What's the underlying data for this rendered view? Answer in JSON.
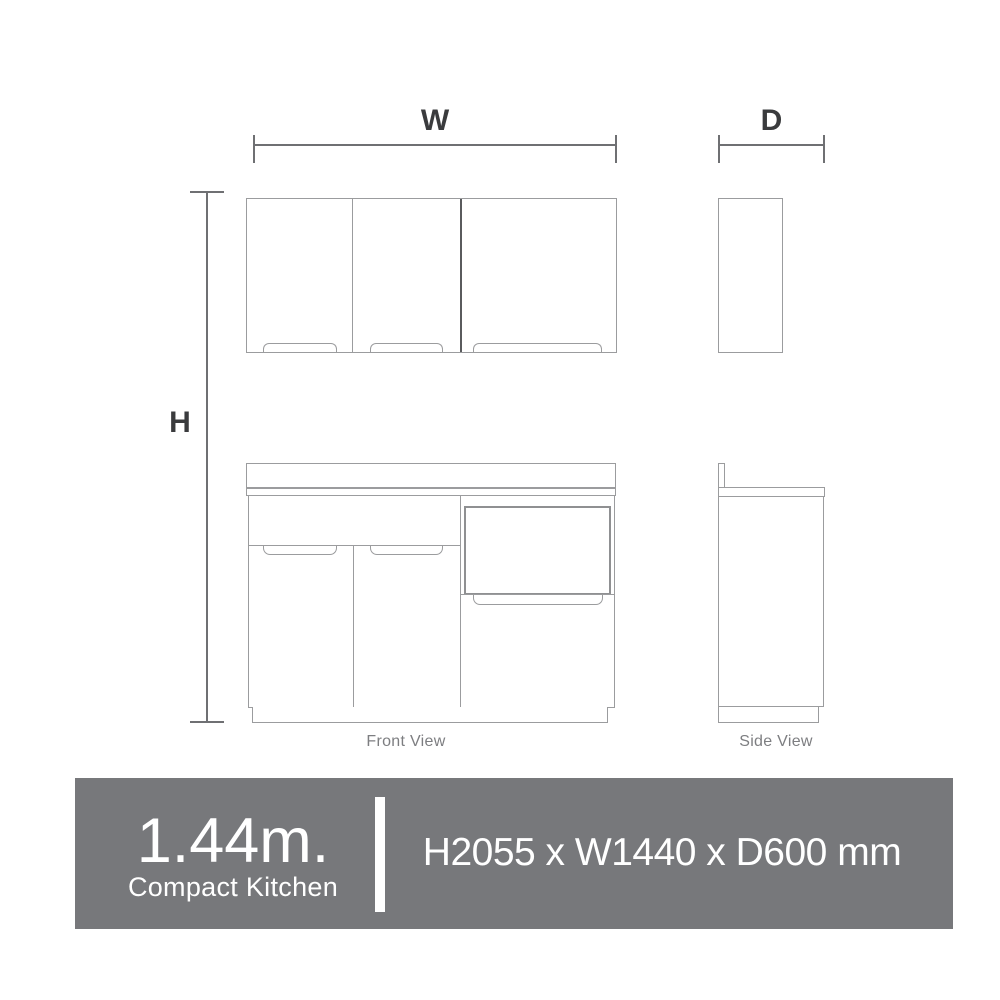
{
  "dimensions": {
    "width_label": "W",
    "depth_label": "D",
    "height_label": "H"
  },
  "views": {
    "front_label": "Front View",
    "side_label": "Side View"
  },
  "banner": {
    "size": "1.44m.",
    "name": "Compact Kitchen",
    "spec": "H2055 x W1440 x D600 mm",
    "bg_color": "#77787b",
    "text_color": "#ffffff"
  },
  "colors": {
    "cabinet_outline": "#9b9c9e",
    "dimension_line": "#6f7073",
    "dimension_label": "#3a3b3d",
    "view_label": "#7d7e81"
  }
}
